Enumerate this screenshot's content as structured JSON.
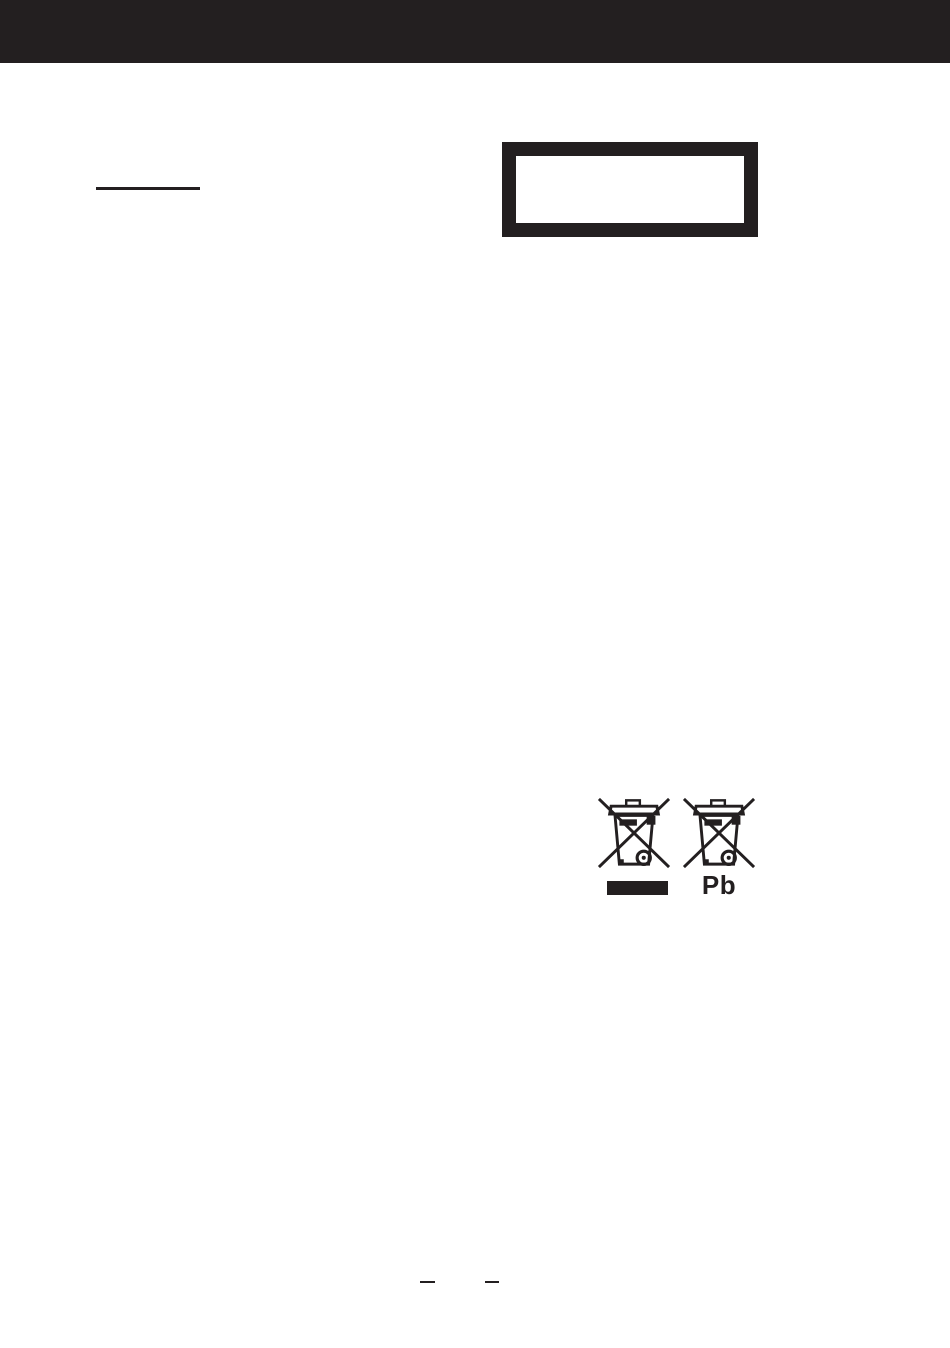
{
  "page": {
    "background_color": "#ffffff",
    "ink_color": "#231f20"
  },
  "header_bar": {
    "color": "#231f20"
  },
  "notice_box": {
    "border_color": "#231f20",
    "content": ""
  },
  "weee": {
    "icon_left": "crossed-out-wheelie-bin",
    "icon_right": "crossed-out-wheelie-bin",
    "pb_label": "Pb",
    "bar_color": "#231f20"
  }
}
